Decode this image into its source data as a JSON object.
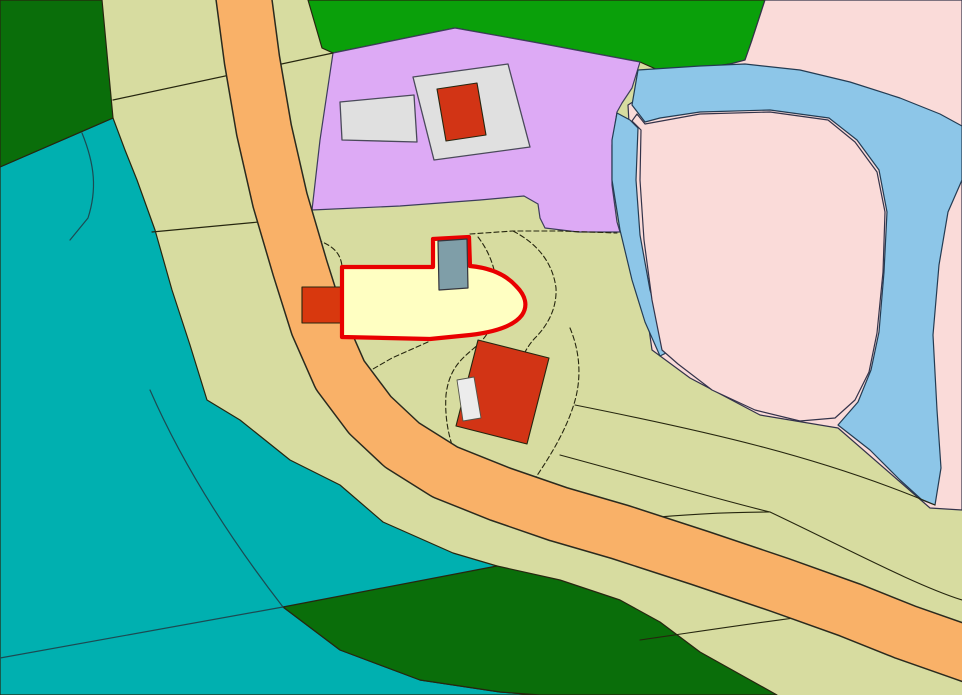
{
  "map": {
    "canvas": {
      "width": 962,
      "height": 695
    },
    "palette": {
      "parcel_khaki": "#d7dca0",
      "forest_dark_green": "#0a6e0a",
      "forest_bright_green": "#0aa00a",
      "water_teal": "#00b0b0",
      "residential_purple": "#ddaaf5",
      "meadow_pink": "#fadbd9",
      "river_blue": "#8dc6e8",
      "road_orange": "#f9b168",
      "building_red": "#d23415",
      "building_pad_gray": "#e0e0e0",
      "building_gray_blue": "#7f9ea8",
      "selected_fill_yellow": "#ffffc2",
      "selection_outline_red": "#e90000",
      "boundary_dark": "#26260f",
      "boundary_slate": "#3d3d5c",
      "river_outline": "#233b52"
    },
    "layers": [
      {
        "name": "parcel-base-khaki",
        "d": "M0,0 H962 V695 H0 Z",
        "fill": "#d7dca0",
        "stroke": "none",
        "sw": 0,
        "dash": "",
        "interactable": true
      },
      {
        "name": "water-area-teal",
        "d": "M0,167 L113,118 L125,150 L137,180 L155,230 L172,290 L190,345 L207,400 L240,420 L290,460 L340,485 L383,522 L453,553 L497,566 L430,585 L350,600 L283,607 L340,650 L420,680 L500,692 L540,695 L0,695 Z",
        "fill": "#00b0b0",
        "stroke": "#26260f",
        "sw": 1.2,
        "dash": "",
        "interactable": true
      },
      {
        "name": "forest-top-left",
        "d": "M0,0 L102,0 L113,118 L0,167 Z",
        "fill": "#0a6e0a",
        "stroke": "#26260f",
        "sw": 1.2,
        "dash": "",
        "interactable": true
      },
      {
        "name": "forest-top-center",
        "d": "M308,0 L765,0 L752,40 L745,62 L700,68 L658,70 L640,62 L533,42 L455,28 L333,53 L322,48 Z",
        "fill": "#0aa00a",
        "stroke": "#26260f",
        "sw": 1.2,
        "dash": "",
        "interactable": true
      },
      {
        "name": "forest-bottom-wedge",
        "d": "M283,607 L497,566 L560,580 L620,600 L660,622 L700,652 L777,695 L540,695 L500,692 L420,680 L340,650 Z",
        "fill": "#0a6e0a",
        "stroke": "#26260f",
        "sw": 1.2,
        "dash": "",
        "interactable": true
      },
      {
        "name": "residential-area-purple",
        "d": "M333,53 L455,28 L533,42 L640,62 L632,88 L622,103 L617,112 L612,145 L612,185 L617,222 L620,232 L578,232 L545,228 L540,218 L538,204 L524,196 L480,200 L400,206 L312,210 L320,140 Z",
        "fill": "#ddaaf5",
        "stroke": "#3d3d5c",
        "sw": 1.2,
        "dash": "",
        "interactable": true
      },
      {
        "name": "meadow-area-pink",
        "d": "M765,0 L962,0 L962,510 L930,508 L838,428 L760,415 L690,378 L652,350 L635,230 L628,105 L660,85 L700,72 L745,60 L752,40 Z",
        "fill": "#fadbd9",
        "stroke": "#33334a",
        "sw": 1.2,
        "dash": "",
        "interactable": true
      },
      {
        "name": "river-main-loop",
        "d": "M638,70 L700,66 L745,64 L800,70 L850,82 L900,98 L940,114 L962,126 L962,180 L948,212 L939,265 L933,335 L937,410 L941,468 L935,505 L922,500 L900,480 L870,450 L838,425 L858,402 L871,370 L879,332 L884,272 L887,212 L879,170 L857,140 L829,118 L770,110 L700,112 L660,118 L645,122 L632,105 Z",
        "fill": "#8dc6e8",
        "stroke": "#233b52",
        "sw": 1.2,
        "dash": "",
        "interactable": true
      },
      {
        "name": "river-left-branch",
        "d": "M617,113 L630,120 L638,128 L636,180 L640,235 L650,290 L662,330 L668,352 L660,356 L645,322 L632,280 L620,230 L612,180 L612,140 Z",
        "fill": "#8dc6e8",
        "stroke": "#233b52",
        "sw": 1.2,
        "dash": "",
        "interactable": true
      },
      {
        "name": "oxbow-island-pink",
        "d": "M645,124 L700,114 L770,112 L828,120 L855,142 L877,172 L885,212 L883,272 L877,333 L869,372 L855,400 L835,418 L800,421 L755,410 L712,390 L678,364 L662,350 L652,300 L644,240 L640,180 L641,130 L632,121 L637,114 Z",
        "fill": "#fadbd9",
        "stroke": "#33334a",
        "sw": 1.2,
        "dash": "",
        "interactable": true
      },
      {
        "name": "parcel-line-upper-left",
        "d": "M113,100 L333,53",
        "fill": "none",
        "stroke": "#26260f",
        "sw": 1.2,
        "dash": "",
        "interactable": false
      },
      {
        "name": "parcel-line-left",
        "d": "M152,232 L280,220",
        "fill": "none",
        "stroke": "#26260f",
        "sw": 1.2,
        "dash": "",
        "interactable": false
      },
      {
        "name": "stream-line-teal-upper",
        "d": "M82,133 C95,165 97,190 88,218 L70,240",
        "fill": "none",
        "stroke": "#1c4a52",
        "sw": 1.2,
        "dash": "",
        "interactable": false
      },
      {
        "name": "parcel-line-teal-curve",
        "d": "M150,390 C185,470 235,545 283,607",
        "fill": "none",
        "stroke": "#1c4a52",
        "sw": 1.2,
        "dash": "",
        "interactable": false
      },
      {
        "name": "parcel-line-teal-diag",
        "d": "M0,658 L283,607",
        "fill": "none",
        "stroke": "#1c4a52",
        "sw": 1.2,
        "dash": "",
        "interactable": false
      },
      {
        "name": "parcel-line-right-1",
        "d": "M575,405 C700,430 820,456 935,505",
        "fill": "none",
        "stroke": "#26260f",
        "sw": 1.1,
        "dash": "",
        "interactable": false
      },
      {
        "name": "parcel-line-right-2",
        "d": "M560,455 C660,482 720,500 770,512",
        "fill": "none",
        "stroke": "#26260f",
        "sw": 1.1,
        "dash": "",
        "interactable": false
      },
      {
        "name": "parcel-line-right-3",
        "d": "M545,530 C650,515 720,512 770,512",
        "fill": "none",
        "stroke": "#26260f",
        "sw": 1.1,
        "dash": "",
        "interactable": false
      },
      {
        "name": "parcel-line-right-merged",
        "d": "M770,512 C850,550 915,585 962,600",
        "fill": "none",
        "stroke": "#26260f",
        "sw": 1.1,
        "dash": "",
        "interactable": false
      },
      {
        "name": "parcel-line-bottom-right",
        "d": "M640,640 C750,624 800,616 853,612",
        "fill": "none",
        "stroke": "#26260f",
        "sw": 1.1,
        "dash": "",
        "interactable": false
      },
      {
        "name": "zone-line-to-selected",
        "d": "M286,232 C330,240 340,250 342,266",
        "fill": "none",
        "stroke": "#26260f",
        "sw": 1.1,
        "dash": "5,3",
        "interactable": false
      },
      {
        "name": "zone-line-top-east",
        "d": "M470,234 L513,231 L560,231 L617,233",
        "fill": "none",
        "stroke": "#26260f",
        "sw": 1.1,
        "dash": "5,3",
        "interactable": false
      },
      {
        "name": "zone-line-hug-tip",
        "d": "M478,237 C492,255 499,278 497,306 C494,328 484,340 473,349 C460,360 449,370 446,395 C444,425 452,450 463,472",
        "fill": "none",
        "stroke": "#26260f",
        "sw": 1.1,
        "dash": "5,3",
        "interactable": false
      },
      {
        "name": "zone-line-outer-tip",
        "d": "M513,231 C540,245 553,265 556,288 C557,308 548,325 535,338 C522,352 516,370 518,392",
        "fill": "none",
        "stroke": "#26260f",
        "sw": 1.1,
        "dash": "5,3",
        "interactable": false
      },
      {
        "name": "zone-line-east-vertical",
        "d": "M570,328 C580,352 582,378 574,404 C564,436 545,465 520,500",
        "fill": "none",
        "stroke": "#26260f",
        "sw": 1.1,
        "dash": "5,3",
        "interactable": false
      },
      {
        "name": "zone-line-south-west",
        "d": "M428,342 L392,358 L366,373",
        "fill": "none",
        "stroke": "#26260f",
        "sw": 1.1,
        "dash": "5,3",
        "interactable": false
      },
      {
        "name": "road-casing",
        "d": "M243,-8 L252,60 L264,130 L280,200 L300,268 L318,325 L340,375 L370,415 L402,445 L445,472 L500,494 L558,514 L620,532 L700,558 L780,585 L850,610 L905,632 L962,652 L990,662",
        "fill": "none",
        "stroke": "#2a2a1e",
        "sw": 57,
        "dash": "",
        "interactable": false
      },
      {
        "name": "road-orange",
        "d": "M243,-8 L252,60 L264,130 L280,200 L300,268 L318,325 L340,375 L370,415 L402,445 L445,472 L500,494 L558,514 L620,532 L700,558 L780,585 L850,610 L905,632 L962,652 L990,662",
        "fill": "none",
        "stroke": "#f9b168",
        "sw": 54,
        "dash": "",
        "interactable": true
      },
      {
        "name": "building-pad-corridor",
        "d": "M340,102 L414,95 L417,142 L342,140 Z",
        "fill": "#e0e0e0",
        "stroke": "#4a4a5a",
        "sw": 1.3,
        "dash": "",
        "interactable": true
      },
      {
        "name": "building-pad-gray",
        "d": "M413,77 L508,64 L530,147 L434,160 Z",
        "fill": "#e0e0e0",
        "stroke": "#4a4a5a",
        "sw": 1.3,
        "dash": "",
        "interactable": true
      },
      {
        "name": "building-red-north",
        "d": "M437,89 L477,83 L486,135 L446,141 Z",
        "fill": "#d23415",
        "stroke": "#26260f",
        "sw": 1.1,
        "dash": "",
        "interactable": true
      },
      {
        "name": "building-red-west-annex",
        "d": "M302,287 L342,287 L342,323 L302,323 Z",
        "fill": "#d8380e",
        "stroke": "#26260f",
        "sw": 1.1,
        "dash": "",
        "interactable": true
      },
      {
        "name": "building-red-south",
        "d": "M478,340 L549,358 L527,444 L456,426 Z",
        "fill": "#d23415",
        "stroke": "#26260f",
        "sw": 1.1,
        "dash": "",
        "interactable": true
      },
      {
        "name": "building-white-annex",
        "d": "M457,380 L474,377 L481,418 L463,421 Z",
        "fill": "#ececec",
        "stroke": "#55554a",
        "sw": 0.9,
        "dash": "",
        "interactable": true
      },
      {
        "name": "selected-building-yellow",
        "d": "M342,267 L433,267 L433,239 L469,237 L470,266 C492,268 507,276 516,286 C526,296 528,306 522,315 C514,326 495,332 470,335 L430,339 L342,337 Z",
        "fill": "#ffffc2",
        "stroke": "#e90000",
        "sw": 4.2,
        "dash": "",
        "interactable": true
      },
      {
        "name": "building-gray-blue",
        "d": "M438,241 L467,239 L468,288 L439,290 Z",
        "fill": "#7f9ea8",
        "stroke": "#34343c",
        "sw": 1.2,
        "dash": "",
        "interactable": true
      }
    ]
  }
}
